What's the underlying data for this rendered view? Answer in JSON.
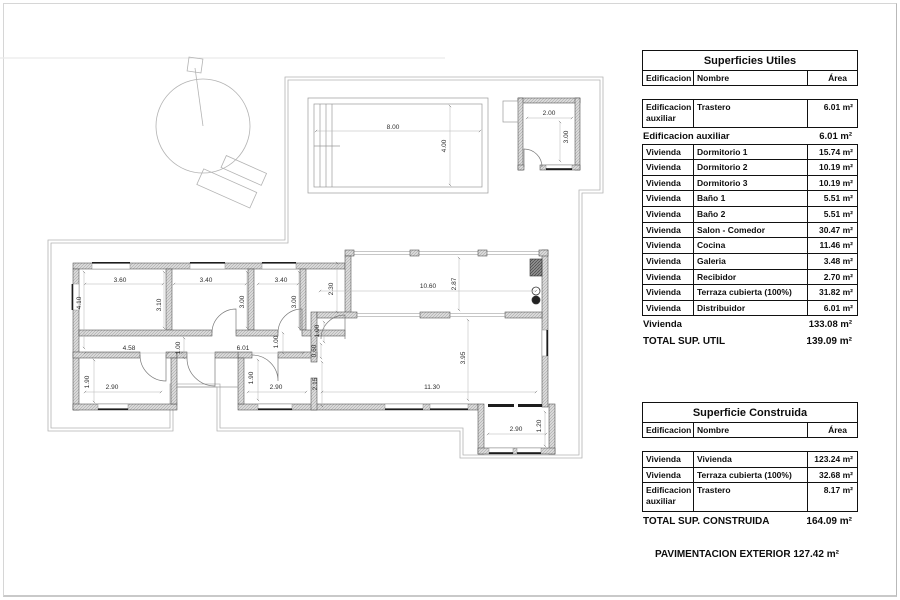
{
  "plan": {
    "dims": [
      "8.00",
      "4.00",
      "2.00",
      "3.00",
      "3.60",
      "3.40",
      "3.40",
      "2.30",
      "4.10",
      "3.10",
      "3.00",
      "3.00",
      "10.60",
      "2.87",
      "4.58",
      "1.00",
      "6.01",
      "1.00",
      "1.00",
      "0.60",
      "2.15",
      "1.90",
      "2.90",
      "1.90",
      "2.90",
      "11.30",
      "3.95",
      "2.90",
      "1.20"
    ]
  },
  "tables": {
    "utiles": {
      "title": "Superficies Utiles",
      "headers": [
        "Edificacion",
        "Nombre",
        "Área"
      ],
      "rows": [
        {
          "type": "detail",
          "tall": true,
          "cells": [
            "Edificacion auxiliar",
            "Trastero",
            "6.01 m²"
          ]
        },
        {
          "type": "subtotal",
          "cells": [
            "Edificacion auxiliar",
            "6.01 m²"
          ]
        },
        {
          "type": "detail",
          "cells": [
            "Vivienda",
            "Dormitorio 1",
            "15.74 m²"
          ]
        },
        {
          "type": "detail",
          "cells": [
            "Vivienda",
            "Dormitorio 2",
            "10.19 m²"
          ]
        },
        {
          "type": "detail",
          "cells": [
            "Vivienda",
            "Dormitorio 3",
            "10.19 m²"
          ]
        },
        {
          "type": "detail",
          "cells": [
            "Vivienda",
            "Baño 1",
            "5.51 m²"
          ]
        },
        {
          "type": "detail",
          "cells": [
            "Vivienda",
            "Baño 2",
            "5.51 m²"
          ]
        },
        {
          "type": "detail",
          "cells": [
            "Vivienda",
            "Salon - Comedor",
            "30.47 m²"
          ]
        },
        {
          "type": "detail",
          "cells": [
            "Vivienda",
            "Cocina",
            "11.46 m²"
          ]
        },
        {
          "type": "detail",
          "cells": [
            "Vivienda",
            "Galeria",
            "3.48 m²"
          ]
        },
        {
          "type": "detail",
          "cells": [
            "Vivienda",
            "Recibidor",
            "2.70 m²"
          ]
        },
        {
          "type": "detail",
          "cells": [
            "Vivienda",
            "Terraza cubierta (100%)",
            "31.82 m²"
          ]
        },
        {
          "type": "detail",
          "cells": [
            "Vivienda",
            "Distribuidor",
            "6.01 m²"
          ]
        },
        {
          "type": "subtotal",
          "cells": [
            "Vivienda",
            "133.08 m²"
          ]
        },
        {
          "type": "total",
          "cells": [
            "TOTAL SUP. UTIL",
            "139.09 m²"
          ]
        }
      ]
    },
    "construida": {
      "title": "Superficie Construida",
      "headers": [
        "Edificacion",
        "Nombre",
        "Área"
      ],
      "rows": [
        {
          "type": "detail",
          "cells": [
            "Vivienda",
            "Vivienda",
            "123.24 m²"
          ]
        },
        {
          "type": "detail",
          "cells": [
            "Vivienda",
            "Terraza cubierta (100%)",
            "32.68 m²"
          ]
        },
        {
          "type": "detail",
          "tall": true,
          "cells": [
            "Edificacion auxiliar",
            "Trastero",
            "8.17 m²"
          ]
        },
        {
          "type": "total",
          "cells": [
            "TOTAL SUP. CONSTRUIDA",
            "164.09 m²"
          ]
        }
      ]
    }
  },
  "footer": {
    "pavimentacion": "PAVIMENTACION EXTERIOR 127.42 m²"
  }
}
